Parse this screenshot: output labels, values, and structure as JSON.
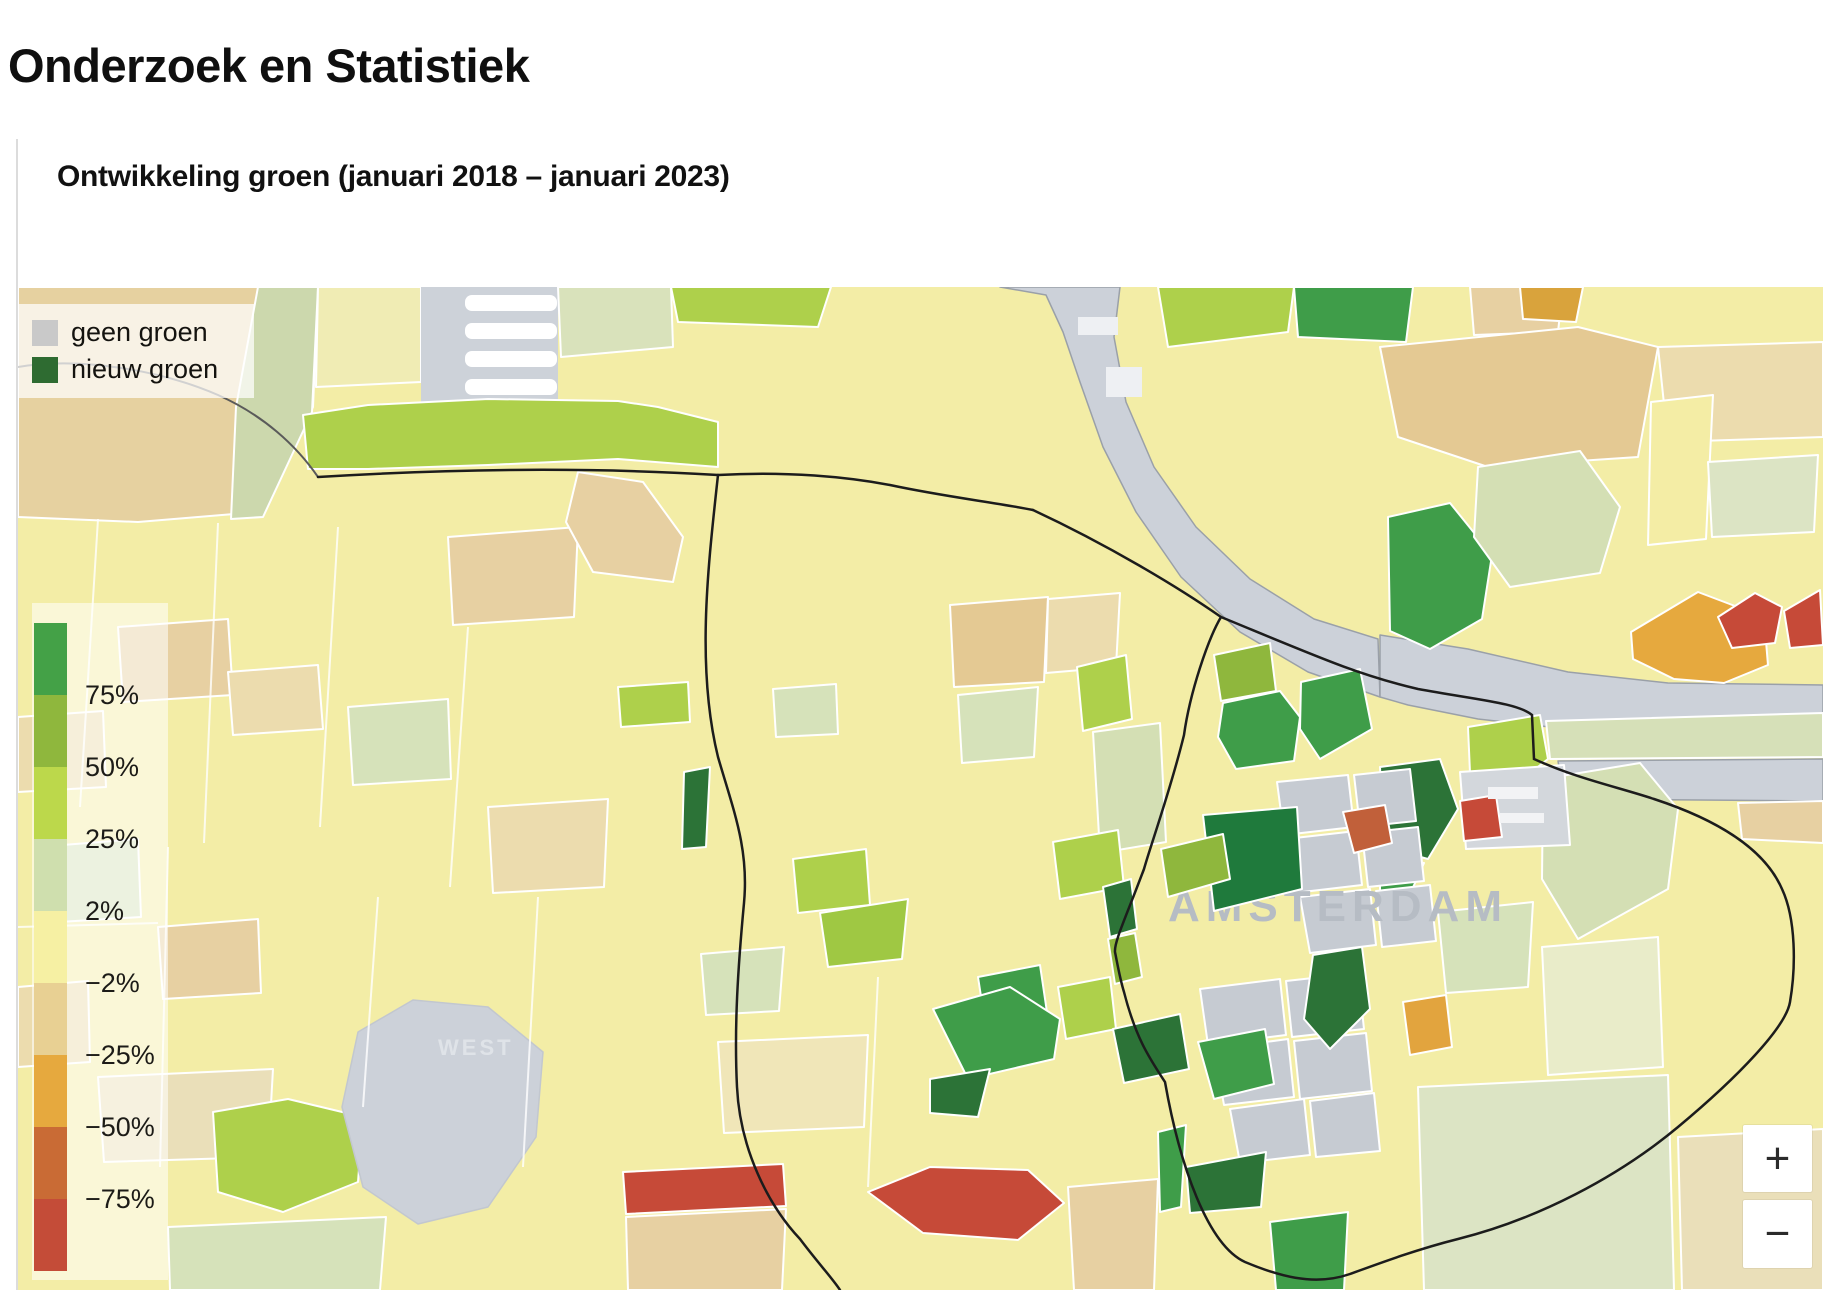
{
  "page": {
    "title": "Onderzoek en Statistiek"
  },
  "figure": {
    "title": "Ontwikkeling groen (januari 2018 – januari 2023)",
    "legend": {
      "items": [
        {
          "label": "geen groen",
          "color": "#c9c9c9"
        },
        {
          "label": "nieuw groen",
          "color": "#2e6b31"
        }
      ]
    },
    "scale": {
      "labels": [
        "75%",
        "50%",
        "25%",
        "2%",
        "−2%",
        "−25%",
        "−50%",
        "−75%"
      ],
      "segment_colors": [
        "#44a147",
        "#8fb73d",
        "#bcd84b",
        "#cfdfae",
        "#f6f0a3",
        "#e8d093",
        "#e6a93e",
        "#c96b35",
        "#c44c38"
      ]
    },
    "map": {
      "place_labels": [
        {
          "text": "WEST"
        },
        {
          "text": "AMSTERDAM"
        }
      ],
      "water_color": "#ccd1d9",
      "no_green_color": "#c6cbd2"
    },
    "controls": {
      "zoom_in": "+",
      "zoom_out": "−"
    }
  }
}
